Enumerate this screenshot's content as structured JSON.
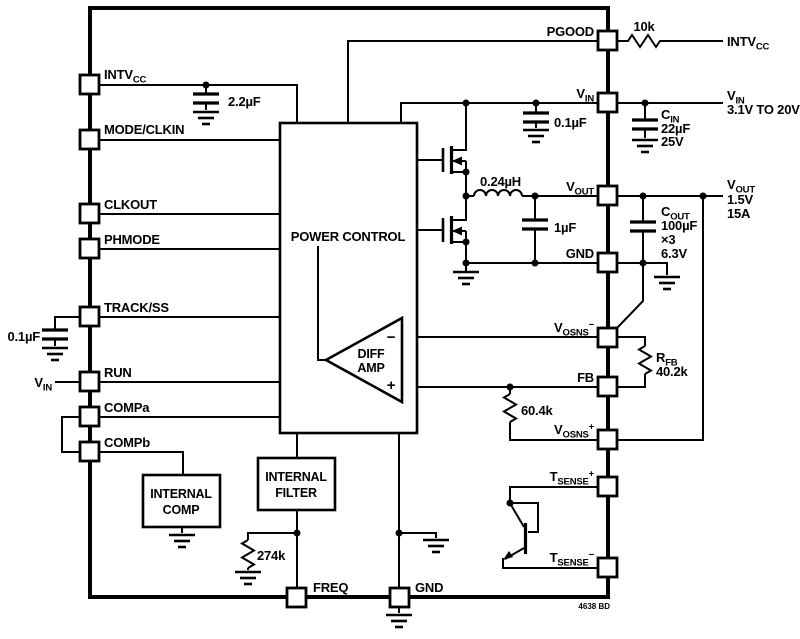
{
  "footer": "4638 BD",
  "pins": {
    "intvcc": {
      "t": "INTV",
      "sub": "CC"
    },
    "mode_clkin": "MODE/CLKIN",
    "clkout": "CLKOUT",
    "phmode": "PHMODE",
    "track_ss": "TRACK/SS",
    "run": "RUN",
    "compa": "COMPa",
    "compb": "COMPb",
    "pgood": "PGOOD",
    "vin": {
      "t": "V",
      "sub": "IN"
    },
    "vout": {
      "t": "V",
      "sub": "OUT"
    },
    "gnd": "GND",
    "vosns_minus": {
      "t": "V",
      "sub": "OSNS",
      "sup": "−"
    },
    "fb": "FB",
    "vosns_plus": {
      "t": "V",
      "sub": "OSNS",
      "sup": "+"
    },
    "tsense_plus": {
      "t": "T",
      "sub": "SENSE",
      "sup": "+"
    },
    "tsense_minus": {
      "t": "T",
      "sub": "SENSE",
      "sup": "−"
    },
    "freq": "FREQ",
    "gnd_bottom": "GND"
  },
  "blocks": {
    "power_control": "POWER CONTROL",
    "diff_amp": {
      "line1": "DIFF",
      "line2": "AMP",
      "minus": "−",
      "plus": "+"
    },
    "internal_filter": {
      "line1": "INTERNAL",
      "line2": "FILTER"
    },
    "internal_comp": {
      "line1": "INTERNAL",
      "line2": "COMP"
    }
  },
  "components": {
    "cap_intvcc": "2.2µF",
    "cap_trackss": "0.1µF",
    "cap_vin_hf": "0.1µF",
    "inductor": "0.24µH",
    "cap_sw": "1µF",
    "res_pgood": "10k",
    "res_freq": "274k",
    "res_fb_lower": "60.4k",
    "rfb": {
      "name": {
        "t": "R",
        "sub": "FB"
      },
      "value": "40.2k"
    },
    "cin": {
      "name": {
        "t": "C",
        "sub": "IN"
      },
      "value": "22µF",
      "rating": "25V"
    },
    "cout": {
      "name": {
        "t": "C",
        "sub": "OUT"
      },
      "value": "100µF",
      "mult": "×3",
      "rating": "6.3V"
    }
  },
  "external": {
    "pgood_pullup_rail": {
      "t": "INTV",
      "sub": "CC"
    },
    "vin_rail": {
      "name": {
        "t": "V",
        "sub": "IN"
      },
      "range": "3.1V TO 20V"
    },
    "vout_rail": {
      "name": {
        "t": "V",
        "sub": "OUT"
      },
      "volts": "1.5V",
      "amps": "15A"
    },
    "run_rail": {
      "t": "V",
      "sub": "IN"
    }
  }
}
